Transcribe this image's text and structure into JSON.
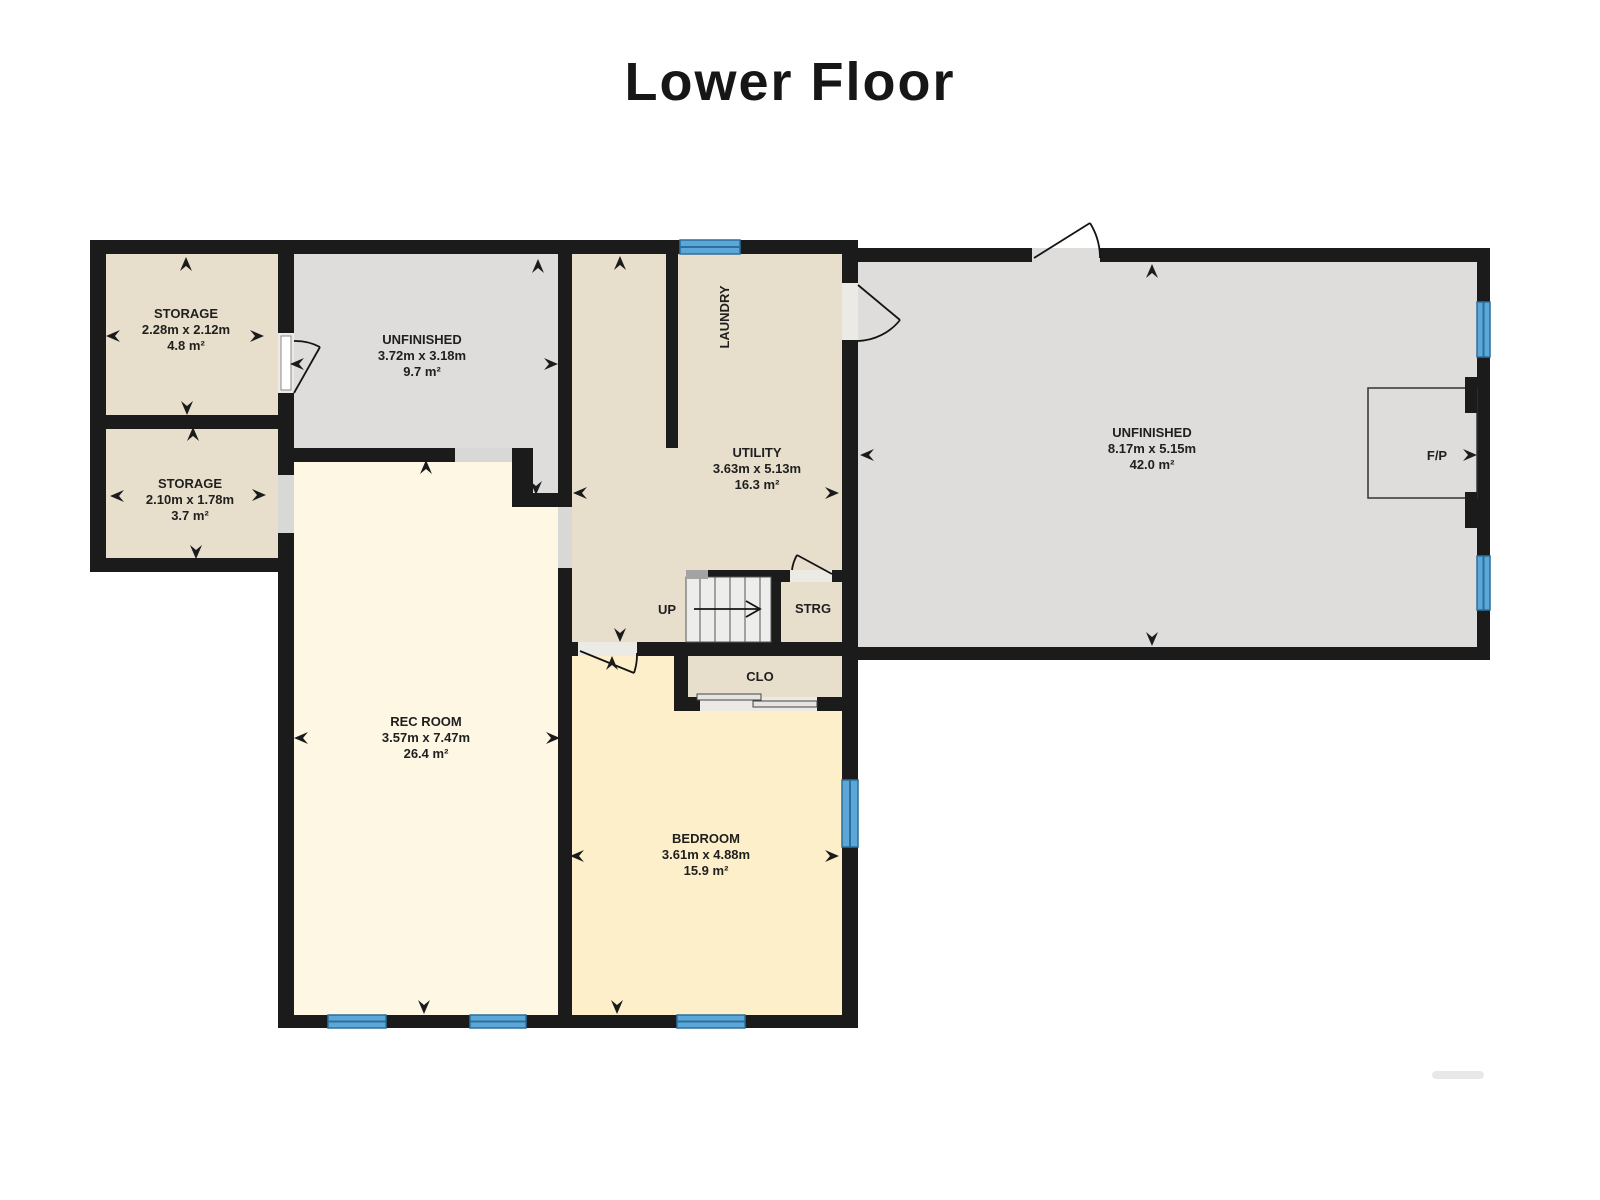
{
  "title": "Lower Floor",
  "rooms": {
    "storage1": {
      "name": "STORAGE",
      "dims": "2.28m x 2.12m",
      "area": "4.8 m²"
    },
    "storage2": {
      "name": "STORAGE",
      "dims": "2.10m x 1.78m",
      "area": "3.7 m²"
    },
    "unfinished_small": {
      "name": "UNFINISHED",
      "dims": "3.72m x 3.18m",
      "area": "9.7 m²"
    },
    "laundry": {
      "name": "LAUNDRY"
    },
    "utility": {
      "name": "UTILITY",
      "dims": "3.63m x 5.13m",
      "area": "16.3 m²"
    },
    "unfinished_large": {
      "name": "UNFINISHED",
      "dims": "8.17m x 5.15m",
      "area": "42.0 m²"
    },
    "fireplace": {
      "name": "F/P"
    },
    "stairs": {
      "name": "UP"
    },
    "storage_nook": {
      "name": "STRG"
    },
    "closet": {
      "name": "CLO"
    },
    "rec_room": {
      "name": "REC ROOM",
      "dims": "3.57m x 7.47m",
      "area": "26.4 m²"
    },
    "bedroom": {
      "name": "BEDROOM",
      "dims": "3.61m x 4.88m",
      "area": "15.9 m²"
    }
  },
  "colors": {
    "wall": "#1b1b1b",
    "beige": "#e7dfcc",
    "gray": "#dedddb",
    "cream": "#fdf7e3",
    "yellow": "#fcefca",
    "win": "#5ba7d7",
    "winstripe": "#2d6f9e",
    "opening": "#d8d8d6"
  }
}
